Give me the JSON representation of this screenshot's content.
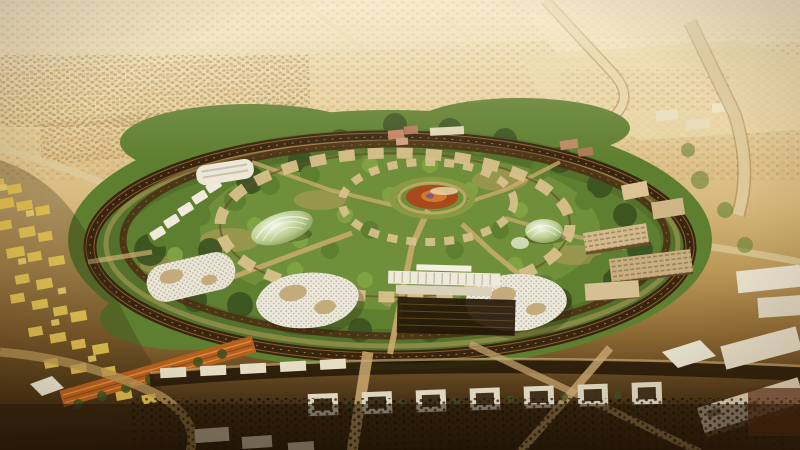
{
  "image": {
    "type": "aerial-architectural-rendering",
    "alt": "Aerial rendering of a vast circular green park ringed by a dark transit loop and white pavilion buildings, set in a tan desert city that stretches to a hazy horizon",
    "width_px": 800,
    "height_px": 450
  },
  "palette": {
    "sky_haze": "#f2e5c2",
    "desert_far": "#e6d1a0",
    "desert_mid": "#d6b97e",
    "park_green": "#5e7f30",
    "park_green_dark": "#3a5220",
    "park_green_light": "#82a544",
    "ring_road_dark": "#38250f",
    "ring_road_mid": "#6b4423",
    "path_tan": "#d8c08a",
    "building_white": "#ece8da",
    "building_tan": "#cdb488",
    "plaza_dark": "#241708",
    "old_town_gold": "#d9b94e",
    "souq_roof_orange": "#b5601f",
    "foreground_brown": "#553d1f",
    "center_red": "#a84a1c"
  },
  "scene": {
    "regions": [
      {
        "name": "desert-sprawl",
        "description": "Hazy low-rise desert city sprawl stretching to the horizon"
      },
      {
        "name": "highways",
        "description": "Pale desert highways and connector roads"
      },
      {
        "name": "circular-park",
        "description": "Vast circular green park of concentric tree rings"
      },
      {
        "name": "ring-road",
        "description": "Dark multi-track transit ring encircling the park"
      },
      {
        "name": "promenade-rings",
        "description": "Tan dashed promenade rings and radial paths inside the park"
      },
      {
        "name": "central-medallion",
        "description": "Red-orange circular garden medallion at the park centre"
      },
      {
        "name": "glass-domes",
        "description": "Striped glass conservatory domes among the trees"
      },
      {
        "name": "white-pavilions",
        "description": "White organic lattice pavilions on the west side of the ring"
      },
      {
        "name": "gateway-complex",
        "description": "Southern gateway with twin perforated wing buildings and terraced plaza"
      },
      {
        "name": "office-slabs",
        "description": "Beige mid-rise slabs along the eastern ring and right edge"
      },
      {
        "name": "old-town",
        "description": "Golden heritage quarter with long orange souq roof on the west"
      },
      {
        "name": "foreground-city",
        "description": "Dense boulevard blocks, white-roofed pavilions and dark orchards in the foreground"
      },
      {
        "name": "atmosphere",
        "description": "Warm desert haze and vignette"
      }
    ]
  }
}
